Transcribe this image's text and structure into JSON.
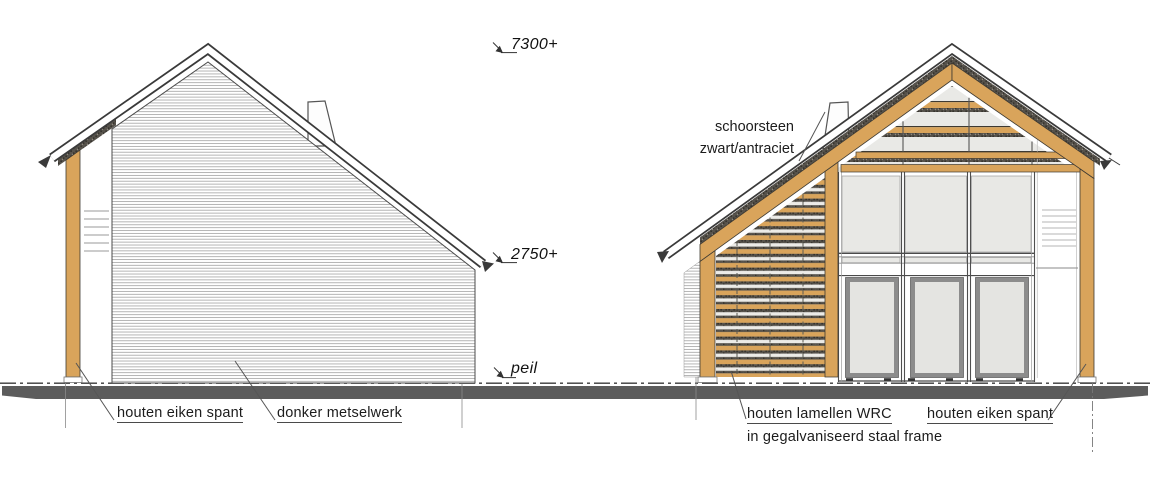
{
  "levels": {
    "ridge": "7300+",
    "eave": "2750+",
    "ground": "peil"
  },
  "left_elevation": {
    "labels": {
      "oak_frame": "houten eiken spant",
      "brickwork": "donker metselwerk"
    }
  },
  "right_elevation": {
    "labels": {
      "chimney_line1": "schoorsteen",
      "chimney_line2": "zwart/antraciet",
      "slats_line1": "houten lamellen WRC",
      "slats_line2": "in gegalvaniseerd staal frame",
      "oak_frame": "houten eiken spant"
    }
  },
  "colors": {
    "wood": "#d9a45b",
    "wood_edge": "#3e3a32",
    "line": "#3a3a3a",
    "pane": "#e8e8e5",
    "hatch": "#a8a8a8",
    "dark_hatch": "#56524b",
    "ground_shadow": "#5c5c5c"
  }
}
